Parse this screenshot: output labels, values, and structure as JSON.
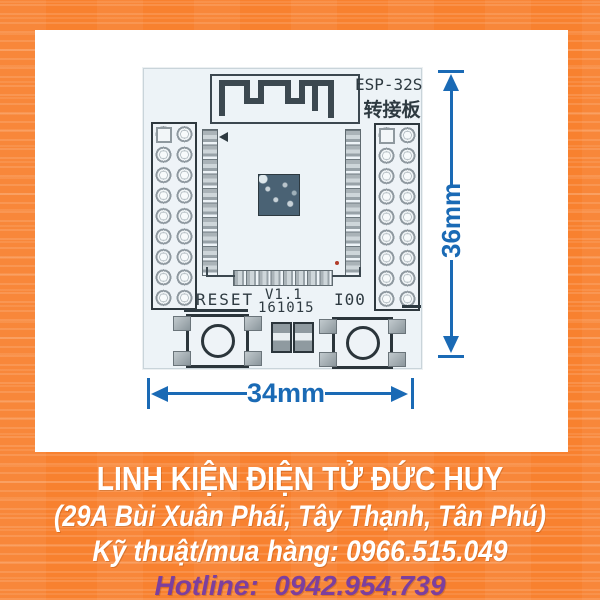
{
  "pcb": {
    "model": "ESP-32S",
    "model_cn": "转接板",
    "reset_label": "RESET",
    "version": "V1.1",
    "date_code": "161015",
    "io0_label": "I00"
  },
  "dimensions": {
    "height": "36mm",
    "width": "34mm"
  },
  "banner": {
    "store_name": "LINH KIỆN ĐIỆN TỬ ĐỨC HUY",
    "address": "(29A Bùi Xuân Phái, Tây Thạnh, Tân Phú)",
    "tech_sales": "Kỹ thuật/mua hàng: 0966.515.049",
    "hotline": "Hotline:  0942.954.739"
  },
  "colors": {
    "background_orange": "#f8812f",
    "board": "#edf3f7",
    "silkscreen": "#2e3a41",
    "dimension_blue": "#1a6ab5",
    "banner_text": "#ffffff",
    "hotline_purple": "#7c3f9e"
  }
}
